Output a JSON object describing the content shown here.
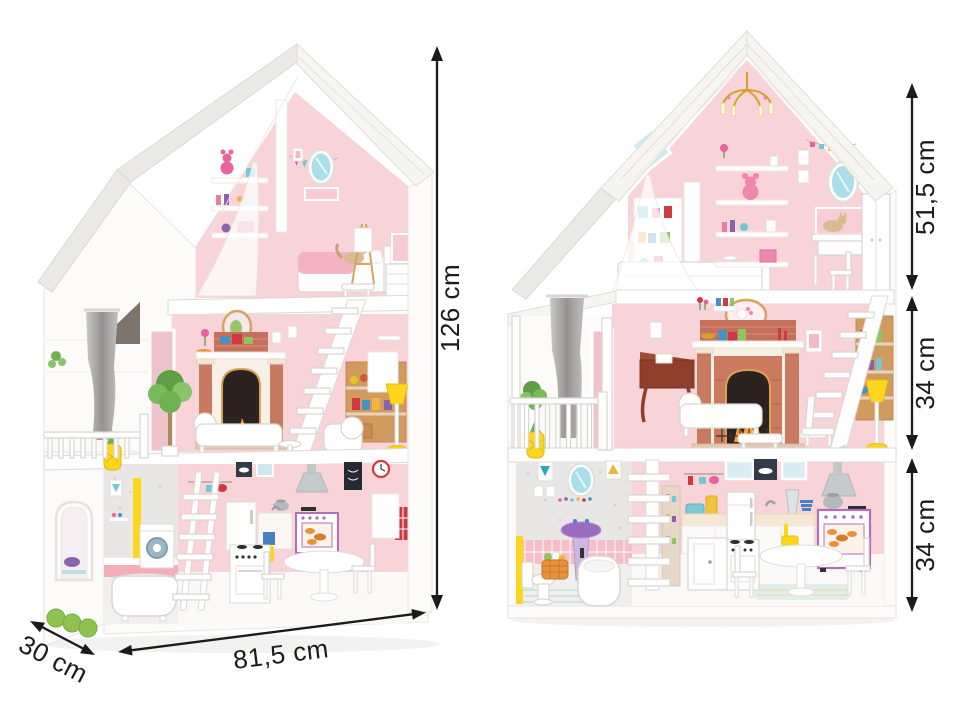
{
  "dimensions": {
    "left_house": {
      "height": "126 cm",
      "width": "81,5 cm",
      "depth": "30 cm"
    },
    "right_house": {
      "attic": "51,5 cm",
      "middle_floor": "34 cm",
      "ground_floor": "34 cm"
    }
  },
  "colors": {
    "background": "#ffffff",
    "dimension_ink": "#1b1b1b",
    "wall_pink": "#f8d3d8",
    "roof_white": "#f6f5f2",
    "accent_yellow": "#ffd61e",
    "brick_red": "#c4705a",
    "stove_purple": "#b06fb6",
    "mirror_blue": "#aadfe9",
    "plant_green": "#6fb254",
    "curtain_gray": "#a9a7a5",
    "basket_orange": "#e8933c"
  }
}
